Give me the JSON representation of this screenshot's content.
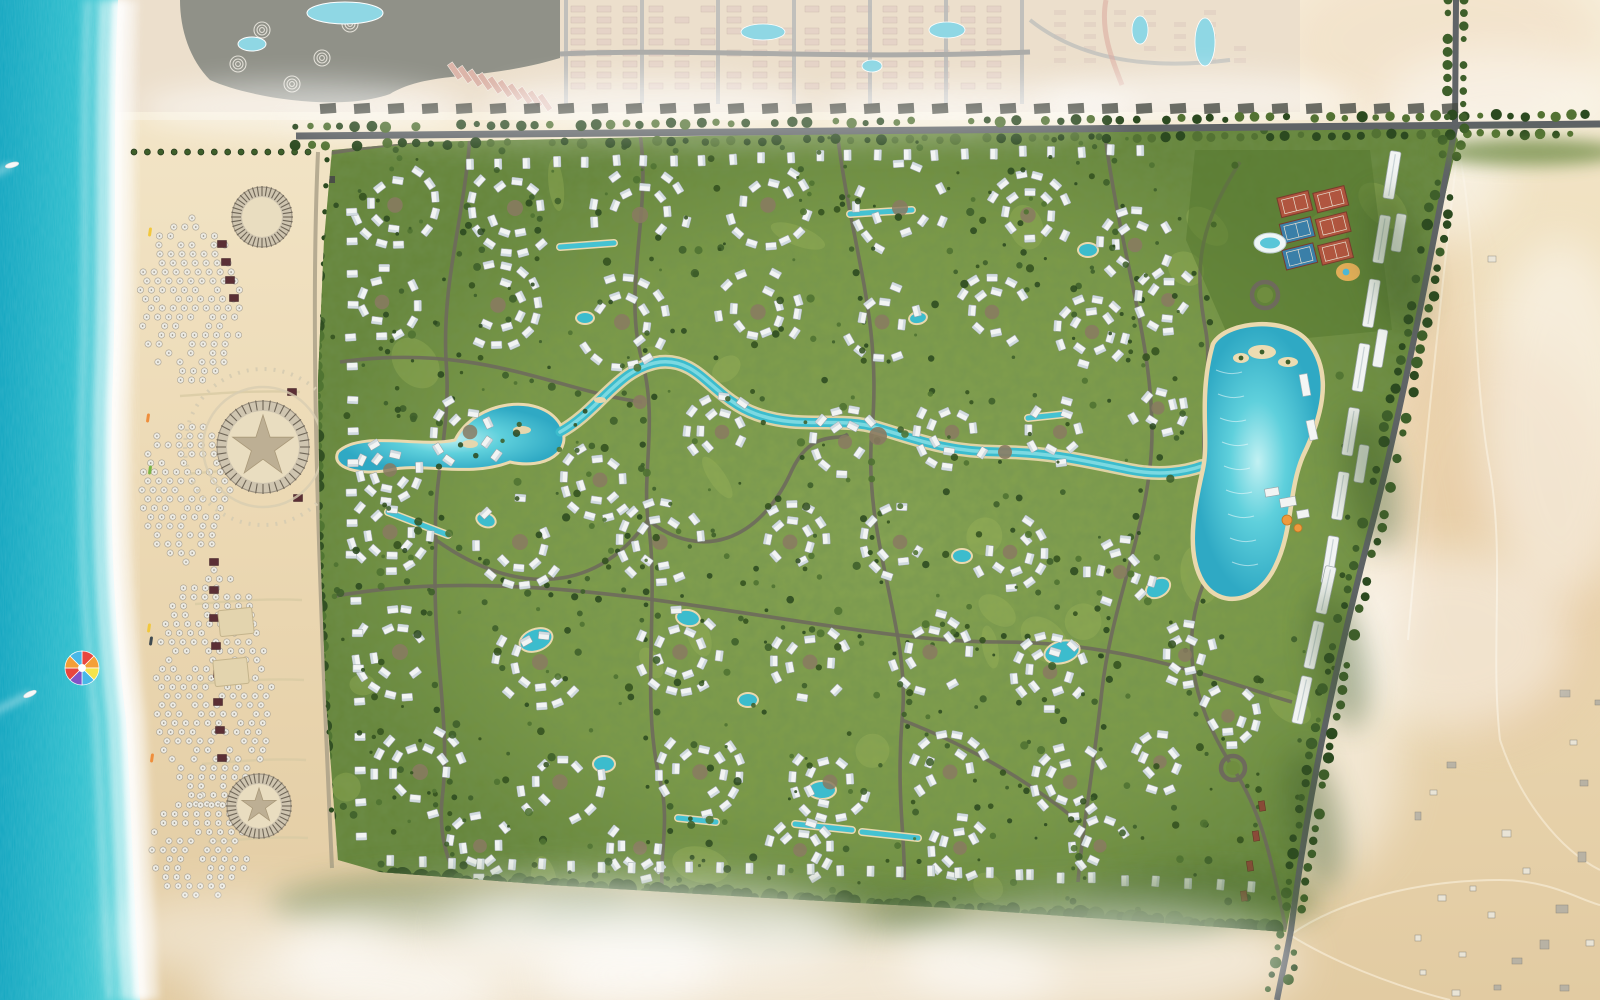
{
  "meta": {
    "description": "Aerial rendered master plan of a beachfront resort community: sea and beach on the west, dense villa development with lagoons in the center, desert to the east, neighboring compounds to the north",
    "canvas_width": 1600,
    "canvas_height": 1000
  },
  "palette": {
    "sea_deep": "#12a6c0",
    "sea_mid": "#2fbfce",
    "sea_shallow": "#8ae2e4",
    "foam": "#ffffff",
    "sand": "#ecd9b4",
    "sand_light": "#f4e8cc",
    "sand_dark": "#e2cba2",
    "desert": "#e8d2ac",
    "desert_pink": "#e2b88e",
    "green_base": "#7c9a47",
    "green_dark": "#66853a",
    "green_light": "#a3bb5e",
    "tree_dark": "#2c4a20",
    "tree_mid": "#3e5f2a",
    "tree_lite": "#4e7231",
    "road_dark": "#5f6366",
    "road_gray": "#8e8e8a",
    "path_tan": "#d9cba4",
    "inner_road": "#6e6a5c",
    "water": "#3cbccd",
    "water_light": "#8ce0e6",
    "water_rim": "#ead9ae",
    "villa_white": "#f2f4f3",
    "villa_shade": "#ccd6dc",
    "villa_edge": "#9aa4a8",
    "cabana": "#5b2f35",
    "plaza_brown": "#8a7a62",
    "court_clay": "#b0553f",
    "court_blue": "#3a7fa8",
    "court_green": "#55792f",
    "neighbor_build": "#dcc3b2",
    "neighbor_roof": "#5c6054",
    "neighbor_pink": "#cf9a8a",
    "pool_blue": "#66c8da",
    "orange": "#ef9a3e",
    "gate_red": "#8a4a38"
  },
  "sea": {
    "width": 118,
    "boats": [
      [
        30,
        694,
        -25
      ],
      [
        12,
        165,
        -15
      ]
    ],
    "parasail": {
      "x": 82,
      "y": 668,
      "r": 17,
      "colors": [
        "#e8463e",
        "#f49f38",
        "#f5e44a",
        "#49b8e8",
        "#8153c6",
        "#e8463e",
        "#f49f38",
        "#49b8e8"
      ]
    },
    "kayaks": [
      [
        150,
        232
      ],
      [
        148,
        418
      ],
      [
        150,
        470
      ],
      [
        149,
        628
      ],
      [
        151,
        641
      ],
      [
        152,
        758
      ]
    ]
  },
  "beach": {
    "umbrella_zones": [
      [
        192,
        300,
        52,
        82
      ],
      [
        186,
        490,
        44,
        72
      ],
      [
        214,
        690,
        58,
        120
      ],
      [
        200,
        848,
        48,
        52
      ]
    ],
    "cabanas": [
      [
        222,
        244
      ],
      [
        226,
        262
      ],
      [
        230,
        280
      ],
      [
        234,
        298
      ],
      [
        214,
        562
      ],
      [
        214,
        590
      ],
      [
        214,
        618
      ],
      [
        216,
        646
      ],
      [
        218,
        674
      ],
      [
        218,
        702
      ],
      [
        220,
        730
      ],
      [
        222,
        758
      ],
      [
        292,
        392
      ],
      [
        298,
        498
      ]
    ],
    "courts": [
      [
        236,
        622,
        34,
        26,
        -6
      ],
      [
        231,
        672,
        34,
        26,
        -6
      ]
    ],
    "pavilions": [
      {
        "cx": 262,
        "cy": 217,
        "r": 30,
        "star": false,
        "walk": false
      },
      {
        "cx": 263,
        "cy": 447,
        "r": 46,
        "star": true,
        "walk": true
      },
      {
        "cx": 259,
        "cy": 806,
        "r": 32,
        "star": true,
        "walk": false
      }
    ],
    "promenade_d": "M332,160 C322,360 330,600 338,860",
    "west_road_d": "M318,152 C310,330 318,560 332,868",
    "cross_paths": [
      "M300,392 C250,390 210,394 180,396",
      "M300,470 C250,468 210,472 185,474",
      "M302,600 C260,598 225,602 195,604",
      "M304,680 C262,678 228,682 198,684",
      "M306,760 C266,758 232,762 202,764",
      "M308,838 C270,836 238,840 208,842"
    ],
    "palm_row_top": [
      134,
      152,
      308,
      152,
      14
    ],
    "lounge_cols": [
      [
        334,
        565,
        680
      ],
      [
        337,
        690,
        845
      ]
    ]
  },
  "neighbors": {
    "strip_h": 112,
    "resort_accents": [
      [
        262,
        30
      ],
      [
        322,
        58
      ],
      [
        238,
        64
      ],
      [
        350,
        24
      ],
      [
        292,
        84
      ]
    ],
    "resort_pools": [
      [
        345,
        13,
        38,
        11
      ],
      [
        252,
        44,
        14,
        7
      ]
    ],
    "pink_road_d": "M1106,0 C1100,30 1112,60 1122,85",
    "mid_span": [
      578,
      1014
    ],
    "mid_pools": [
      [
        763,
        32,
        22,
        8
      ],
      [
        947,
        30,
        18,
        8
      ],
      [
        872,
        66,
        10,
        6
      ],
      [
        1205,
        42,
        10,
        24
      ],
      [
        1140,
        30,
        8,
        14
      ]
    ],
    "right_road_d": "M1030,20 C1080,60 1150,70 1230,60"
  },
  "development": {
    "boundary": [
      [
        332,
        150
      ],
      [
        420,
        142
      ],
      [
        700,
        136
      ],
      [
        1000,
        132
      ],
      [
        1300,
        126
      ],
      [
        1448,
        122
      ],
      [
        1458,
        140
      ],
      [
        1430,
        260
      ],
      [
        1404,
        380
      ],
      [
        1372,
        520
      ],
      [
        1344,
        640
      ],
      [
        1316,
        770
      ],
      [
        1296,
        880
      ],
      [
        1286,
        932
      ],
      [
        1150,
        922
      ],
      [
        950,
        908
      ],
      [
        750,
        897
      ],
      [
        550,
        885
      ],
      [
        380,
        872
      ],
      [
        338,
        860
      ],
      [
        326,
        700
      ],
      [
        320,
        540
      ],
      [
        318,
        380
      ],
      [
        324,
        240
      ]
    ],
    "north_road_d": "M296,136 L1600,124",
    "east_road_d": "M1455,128 C1430,260 1400,420 1368,540 C1340,650 1310,780 1291,930 C1285,962 1280,984 1277,1000",
    "top_branch_d": "M1456,0 L1455,128",
    "south_band_d": "M350,878 C550,890 750,900 950,912 C1100,920 1220,928 1284,934",
    "west_edge_d": "M326,156 C318,340 320,560 336,864",
    "roads": [
      "M300,158 C360,148 420,140 470,136",
      "M470,136 C464,220 442,280 446,360 C452,430 432,480 436,540 C430,650 452,720 442,800 C438,842 452,868 458,884",
      "M640,134 C652,210 622,290 642,360 C658,420 642,470 648,520",
      "M648,520 C700,562 760,542 792,470 C812,428 838,442 848,434",
      "M837,132 C852,250 882,320 872,430 C862,540 912,630 902,720 C896,800 906,842 904,880",
      "M1105,136 C1122,260 1152,340 1152,432 C1152,520 1112,600 1102,690 C1092,780 1082,832 1078,882",
      "M336,596 C560,556 820,642 1000,642 C1130,642 1222,682 1292,702",
      "M340,362 C480,342 560,392 642,402",
      "M1240,162 C1202,222 1192,262 1206,332 C1212,368 1200,420 1205,466",
      "M902,720 C980,750 1040,790 1076,820",
      "M436,540 C520,600 600,590 648,520",
      "M1205,580 C1180,640 1190,700 1233,768 C1260,810 1270,850 1286,930",
      "M648,520 C660,600 640,700 660,780 C670,820 660,850 662,886"
    ],
    "west_lagoon_d": "M338,452 C360,430 420,448 455,440 C475,400 540,392 560,424 C575,452 545,470 510,462 C470,478 420,462 390,470 C360,476 330,468 338,452 Z",
    "water_spine_d": "M560,432 C600,410 618,368 660,362 C700,358 712,398 756,414 C800,430 838,416 878,428 C918,440 948,452 1000,452 C1050,452 1090,462 1130,470 C1160,476 1185,472 1202,466",
    "spine_islands": [
      [
        470,
        444,
        8,
        4
      ],
      [
        522,
        430,
        9,
        4
      ],
      [
        600,
        400,
        6,
        3
      ]
    ],
    "ponds": [
      [
        536,
        640,
        16,
        10,
        -20
      ],
      [
        688,
        618,
        11,
        7,
        10
      ],
      [
        822,
        790,
        13,
        8,
        0
      ],
      [
        1062,
        652,
        17,
        10,
        -15
      ],
      [
        604,
        764,
        10,
        7,
        0
      ],
      [
        962,
        556,
        9,
        6,
        0
      ],
      [
        486,
        520,
        9,
        6,
        20
      ],
      [
        1158,
        588,
        12,
        8,
        -30
      ],
      [
        748,
        700,
        9,
        6,
        0
      ],
      [
        585,
        318,
        8,
        5,
        0
      ],
      [
        918,
        318,
        8,
        5,
        -10
      ],
      [
        1088,
        250,
        9,
        6,
        0
      ]
    ],
    "linear_pools": [
      [
        560,
        247,
        614,
        243
      ],
      [
        850,
        214,
        912,
        210
      ],
      [
        1028,
        418,
        1066,
        414
      ],
      [
        678,
        818,
        716,
        822
      ],
      [
        795,
        824,
        852,
        830
      ],
      [
        862,
        832,
        918,
        838
      ],
      [
        388,
        512,
        448,
        535
      ]
    ],
    "grand_lagoon": {
      "d": "M1215,345 C1228,323 1287,318 1307,344 C1332,376 1318,420 1301,455 C1286,490 1291,530 1273,566 C1256,601 1221,606 1205,581 C1188,553 1196,510 1205,470 C1212,440 1200,398 1215,345 Z",
      "islands": [
        [
          1262,
          352,
          14,
          7
        ],
        [
          1288,
          362,
          10,
          5
        ],
        [
          1241,
          358,
          8,
          5
        ]
      ],
      "decks": [
        [
          1305,
          385,
          8,
          22,
          -10
        ],
        [
          1312,
          430,
          8,
          20,
          -12
        ]
      ]
    },
    "sports_club": {
      "pad": [
        [
          1195,
          150
        ],
        [
          1370,
          150
        ],
        [
          1392,
          330
        ],
        [
          1232,
          345
        ],
        [
          1186,
          240
        ]
      ],
      "rot": -14,
      "cx": 1322,
      "cy": 222,
      "courts": [
        [
          1300,
          198,
          0
        ],
        [
          1336,
          202,
          0
        ],
        [
          1296,
          224,
          1
        ],
        [
          1332,
          228,
          0
        ],
        [
          1292,
          250,
          1
        ],
        [
          1328,
          254,
          0
        ]
      ],
      "pool": [
        1270,
        243
      ],
      "kids": [
        1348,
        272
      ]
    },
    "roundabouts": [
      [
        1265,
        295,
        13
      ],
      [
        1233,
        768,
        12
      ]
    ],
    "apartment_line": [
      1392,
      175,
      1330,
      560,
      7
    ],
    "apartment_line2": [
      1326,
      590,
      1302,
      700,
      3
    ],
    "apartment_offset_ts": [
      0.15,
      0.45,
      0.75
    ],
    "gatehouses": [
      [
        1262,
        806
      ],
      [
        1256,
        836
      ],
      [
        1250,
        866
      ],
      [
        1244,
        896
      ]
    ],
    "clubhouse": {
      "blocks": [
        [
          1272,
          492,
          14,
          8,
          -10
        ],
        [
          1288,
          502,
          16,
          9,
          -10
        ],
        [
          1303,
          514,
          12,
          8,
          -10
        ]
      ],
      "domes": [
        [
          1287,
          520,
          5
        ],
        [
          1298,
          528,
          4
        ]
      ]
    },
    "plazas": [
      [
        878,
        436,
        9
      ],
      [
        640,
        402,
        7
      ],
      [
        1005,
        452,
        7
      ]
    ],
    "villa_clusters": [
      [
        395,
        205,
        46
      ],
      [
        515,
        208,
        50
      ],
      [
        640,
        215,
        52
      ],
      [
        768,
        205,
        46
      ],
      [
        900,
        208,
        50
      ],
      [
        1028,
        215,
        46
      ],
      [
        1135,
        245,
        40
      ],
      [
        382,
        302,
        40
      ],
      [
        498,
        305,
        46
      ],
      [
        622,
        322,
        50
      ],
      [
        758,
        312,
        46
      ],
      [
        882,
        322,
        42
      ],
      [
        992,
        312,
        40
      ],
      [
        1092,
        332,
        38
      ],
      [
        1168,
        300,
        34
      ],
      [
        390,
        470,
        34
      ],
      [
        470,
        432,
        40
      ],
      [
        600,
        480,
        42
      ],
      [
        722,
        432,
        40
      ],
      [
        845,
        442,
        36
      ],
      [
        952,
        432,
        40
      ],
      [
        1060,
        432,
        36
      ],
      [
        1158,
        408,
        30
      ],
      [
        390,
        532,
        44
      ],
      [
        520,
        542,
        50
      ],
      [
        660,
        542,
        46
      ],
      [
        790,
        542,
        42
      ],
      [
        900,
        542,
        40
      ],
      [
        1010,
        552,
        40
      ],
      [
        1120,
        572,
        36
      ],
      [
        400,
        652,
        50
      ],
      [
        540,
        662,
        50
      ],
      [
        680,
        652,
        46
      ],
      [
        810,
        662,
        42
      ],
      [
        930,
        652,
        44
      ],
      [
        1050,
        672,
        40
      ],
      [
        1185,
        655,
        34
      ],
      [
        420,
        772,
        50
      ],
      [
        560,
        782,
        46
      ],
      [
        700,
        772,
        46
      ],
      [
        830,
        782,
        42
      ],
      [
        950,
        772,
        42
      ],
      [
        1070,
        782,
        40
      ],
      [
        1160,
        762,
        32
      ],
      [
        480,
        846,
        34
      ],
      [
        640,
        848,
        34
      ],
      [
        800,
        850,
        34
      ],
      [
        960,
        848,
        34
      ],
      [
        1100,
        846,
        30
      ],
      [
        1228,
        716,
        32
      ]
    ],
    "villa_rows": [
      [
        470,
        164,
        1140,
        150,
        24
      ],
      [
        392,
        862,
        1020,
        874,
        22
      ],
      [
        1030,
        876,
        1252,
        886,
        8
      ],
      [
        352,
        212,
        352,
        556,
        12
      ],
      [
        357,
        600,
        360,
        838,
        8
      ]
    ],
    "exclusions": [
      [
        1185,
        320,
        150,
        300
      ],
      [
        1190,
        138,
        210,
        212
      ],
      [
        1350,
        140,
        120,
        430
      ]
    ]
  },
  "desert": {
    "tracks": [
      "M1455,132 C1480,240 1470,360 1490,470 C1505,560 1490,650 1500,740",
      "M1500,740 C1520,800 1560,850 1600,870",
      "M1290,935 C1340,900 1420,880 1500,880 C1550,880 1580,900 1600,905",
      "M1460,130 C1440,300 1420,500 1408,640",
      "M1290,935 C1330,960 1390,985 1450,1000"
    ],
    "buildings": [
      [
        1488,
        256,
        8,
        6
      ],
      [
        1560,
        690,
        10,
        7
      ],
      [
        1502,
        830,
        9,
        7
      ],
      [
        1523,
        868,
        7,
        6
      ],
      [
        1556,
        905,
        12,
        8
      ],
      [
        1488,
        912,
        7,
        6
      ],
      [
        1540,
        940,
        9,
        9
      ],
      [
        1586,
        940,
        8,
        6
      ],
      [
        1459,
        952,
        7,
        5
      ],
      [
        1512,
        958,
        10,
        6
      ],
      [
        1578,
        852,
        8,
        10
      ],
      [
        1470,
        886,
        6,
        5
      ],
      [
        1430,
        790,
        7,
        5
      ],
      [
        1447,
        762,
        9,
        6
      ],
      [
        1415,
        812,
        6,
        8
      ],
      [
        1438,
        895,
        8,
        6
      ],
      [
        1415,
        935,
        6,
        6
      ],
      [
        1452,
        990,
        8,
        6
      ],
      [
        1494,
        985,
        7,
        5
      ],
      [
        1560,
        985,
        9,
        6
      ],
      [
        1420,
        970,
        6,
        5
      ],
      [
        1580,
        780,
        8,
        6
      ],
      [
        1570,
        740,
        7,
        5
      ],
      [
        1595,
        700,
        6,
        5
      ]
    ],
    "haze_blobs": [
      [
        1330,
        300,
        70,
        160
      ],
      [
        1350,
        560,
        60,
        140
      ],
      [
        1320,
        760,
        80,
        120
      ],
      [
        1420,
        180,
        90,
        60
      ],
      [
        1560,
        420,
        80,
        180
      ],
      [
        1450,
        640,
        120,
        90
      ],
      [
        1500,
        100,
        120,
        50
      ]
    ],
    "pink_patches": [
      [
        1440,
        40,
        160,
        90
      ],
      [
        1500,
        540,
        120,
        200
      ],
      [
        1380,
        300,
        80,
        120
      ]
    ]
  },
  "south_haze": {
    "white": [
      [
        500,
        960,
        220,
        70
      ],
      [
        800,
        975,
        260,
        60
      ],
      [
        1100,
        960,
        200,
        60
      ],
      [
        350,
        990,
        150,
        50
      ],
      [
        650,
        930,
        200,
        50
      ]
    ],
    "green": [
      [
        450,
        905,
        180,
        30
      ],
      [
        750,
        915,
        220,
        30
      ],
      [
        1050,
        918,
        180,
        28
      ],
      [
        1200,
        900,
        120,
        30
      ]
    ]
  }
}
